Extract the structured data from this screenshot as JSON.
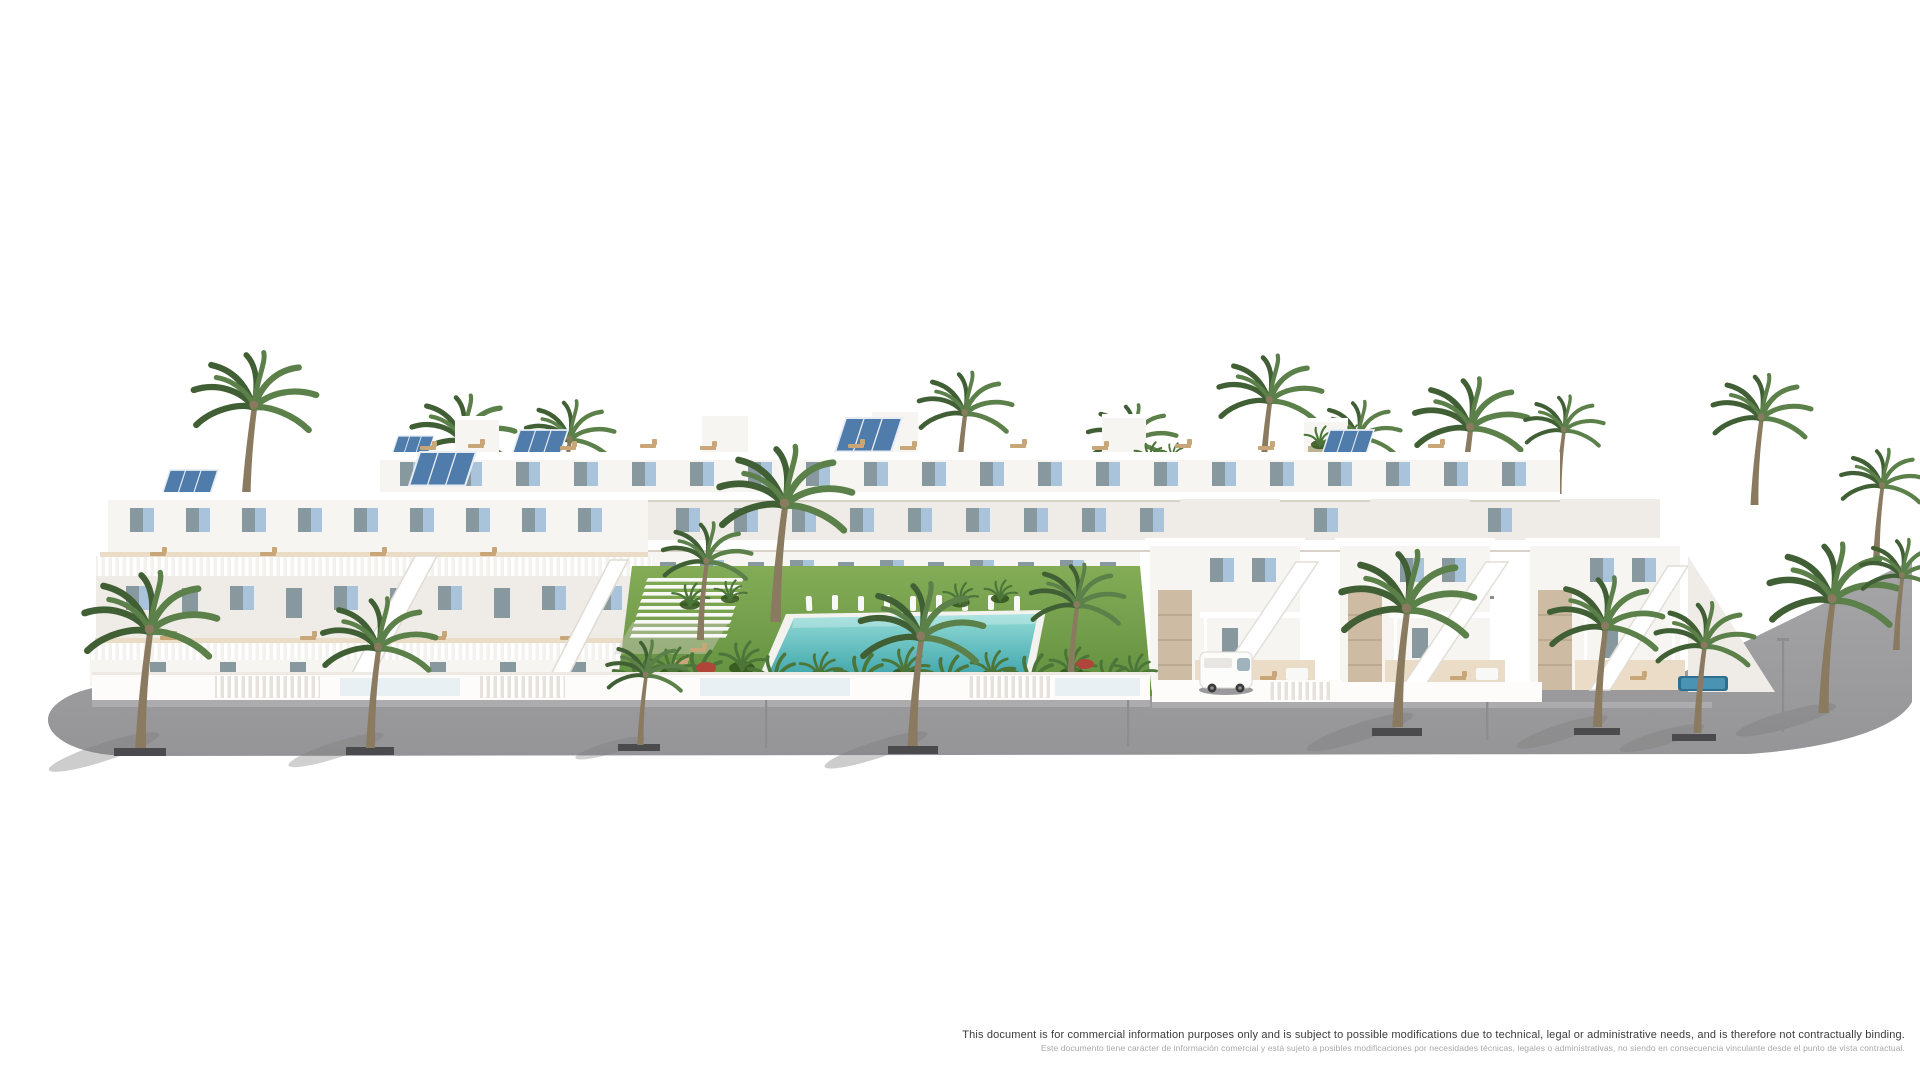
{
  "page": {
    "background": "#ffffff",
    "width": 1920,
    "height": 1080
  },
  "disclaimer": {
    "line1": "This document is for commercial information purposes only and is subject to possible modifications due to technical, legal or administrative needs, and is therefore not contractually binding.",
    "line2": "Este documento tiene carácter de información comercial y está sujeto a posibles modificaciones por necesidades técnicas, legales o administrativas, no siendo en consecuencia vinculante desde el punto de vista contractual."
  },
  "scene": {
    "type": "architectural-render",
    "subject": "Modern white residential complex with communal garden, swimming pool and palm-lined street",
    "elements": [
      "terraced white apartment blocks with roof terraces and sun loungers",
      "rooftop solar panels",
      "light-blue window shutters and glass balustrades",
      "detached villas with external staircases and stone accent walls",
      "central lawn with white slatted pergola",
      "turquoise communal swimming pool with white sun loungers",
      "tropical plants and red flowering shrubs",
      "palm trees along grey asphalt street with planters and street lamps",
      "parked white van",
      "small private plunge pool at right"
    ]
  },
  "palette": {
    "face": "#f7f5f1",
    "face2": "#efebe6",
    "shade": "#e2ddd5",
    "line": "#d8d2c9",
    "white": "#ffffff",
    "glass": "#87989f",
    "blue": "#a9c3da",
    "blue2": "#8fb0cb",
    "solar": "#4f7cab",
    "sand": "#eadcc6",
    "wood": "#c8a678",
    "stone": "#cdbba3",
    "plant": "#4c7639",
    "plant2": "#35571f",
    "frond": "#5c8049",
    "frond2": "#415f34",
    "trunk": "#8a7a60",
    "red": "#b0453a",
    "road": "#9d9d9f",
    "curb": "#c6c6c8",
    "planter": "#4b4b4d",
    "lamp": "#8d8d8f",
    "shadow": "#7c7c7e",
    "text_dark": "#3b3b3b",
    "text_light": "#a8a8a8"
  }
}
